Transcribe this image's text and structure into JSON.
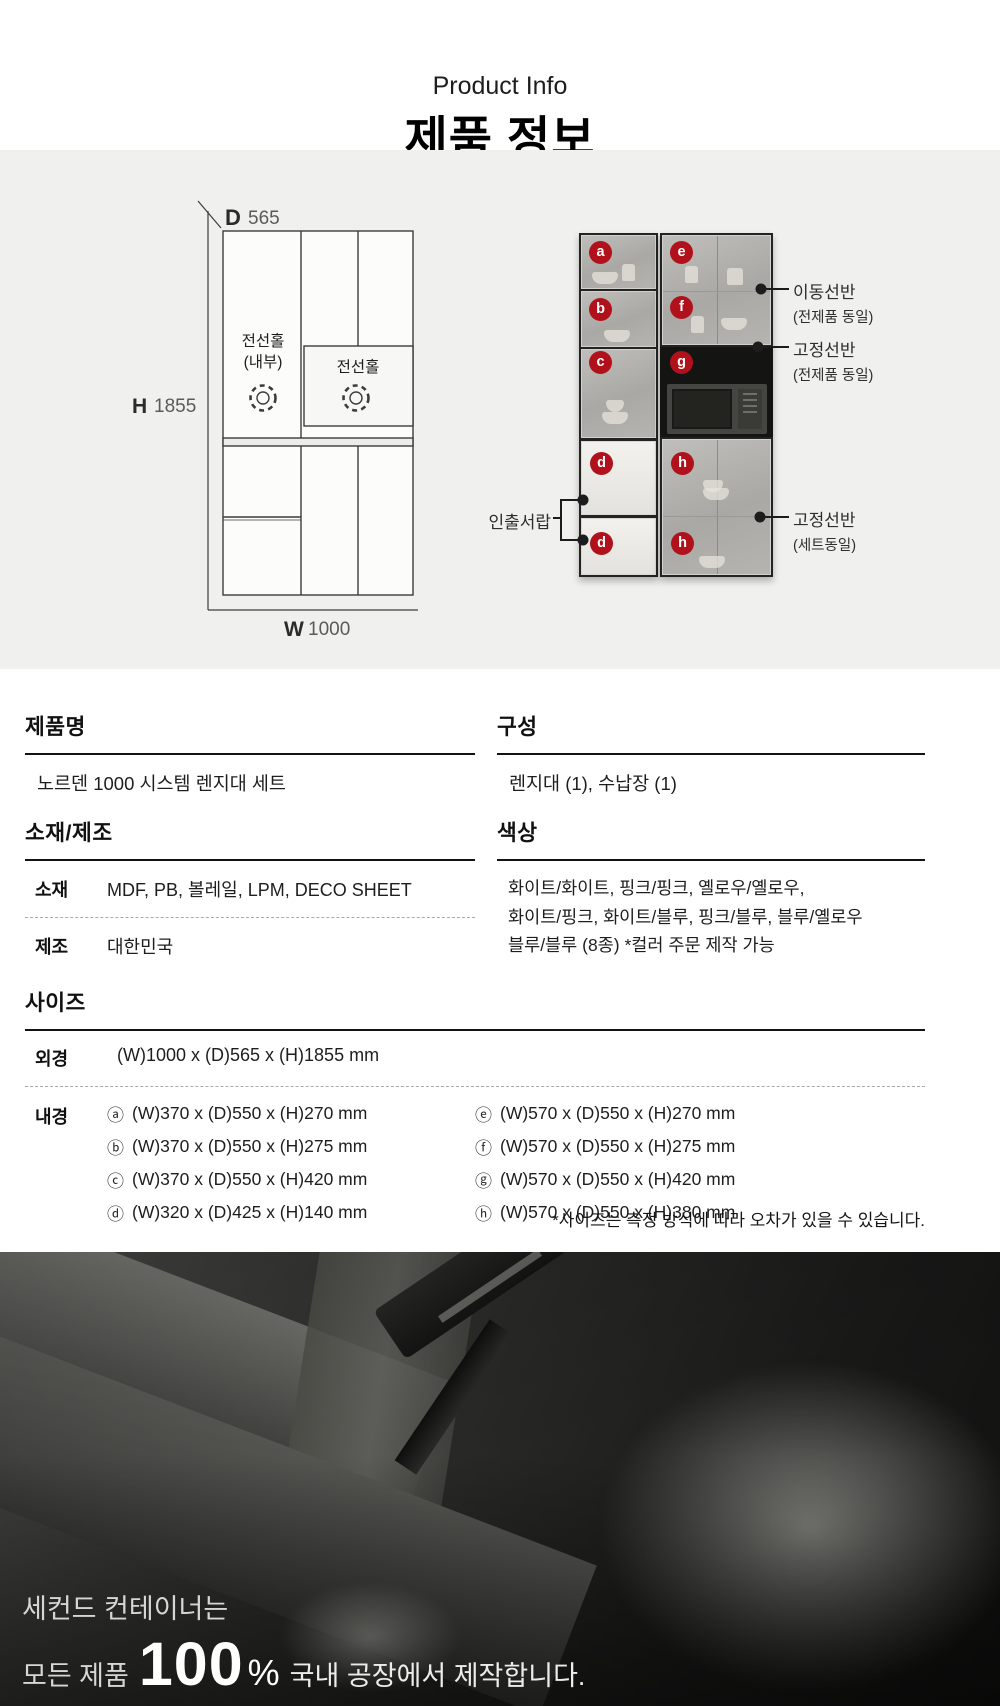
{
  "header": {
    "eyebrow": "Product Info",
    "title": "제품 정보"
  },
  "diagram": {
    "d_label": "D",
    "d_value": "565",
    "h_label": "H",
    "h_value": "1855",
    "w_label": "W",
    "w_value": "1000",
    "wire_hole_line1": "전선홀",
    "wire_hole_line2": "(내부)",
    "wire_hole_shelf": "전선홀"
  },
  "photo": {
    "left_badges": [
      "a",
      "b",
      "c",
      "d",
      "d"
    ],
    "right_badges": [
      "e",
      "f",
      "g",
      "h",
      "h"
    ],
    "callout_moving_shelf_title": "이동선반",
    "callout_moving_shelf_sub": "(전제품 동일)",
    "callout_fixed_shelf_title": "고정선반",
    "callout_fixed_shelf_sub": "(전제품 동일)",
    "callout_drawer": "인출서랍",
    "callout_fixed_shelf2_title": "고정선반",
    "callout_fixed_shelf2_sub": "(세트동일)"
  },
  "details": {
    "product_name": {
      "heading": "제품명",
      "value": "노르덴 1000 시스템 렌지대 세트"
    },
    "composition": {
      "heading": "구성",
      "value": "렌지대 (1), 수납장 (1)"
    },
    "material": {
      "heading": "소재/제조",
      "rows": [
        {
          "label": "소재",
          "value": "MDF, PB, 볼레일, LPM, DECO SHEET"
        },
        {
          "label": "제조",
          "value": "대한민국"
        }
      ]
    },
    "color": {
      "heading": "색상",
      "lines": [
        "화이트/화이트, 핑크/핑크, 옐로우/옐로우,",
        "화이트/핑크, 화이트/블루, 핑크/블루, 블루/옐로우",
        "블루/블루 (8종) *컬러 주문 제작 가능"
      ]
    },
    "size": {
      "heading": "사이즈",
      "outer_label": "외경",
      "outer_value": "(W)1000 x (D)565 x (H)1855 mm",
      "inner_label": "내경",
      "inner_left": [
        {
          "mark": "ⓐ",
          "text": "(W)370 x (D)550 x (H)270 mm"
        },
        {
          "mark": "ⓑ",
          "text": "(W)370 x (D)550 x (H)275 mm"
        },
        {
          "mark": "ⓒ",
          "text": "(W)370 x (D)550 x (H)420 mm"
        },
        {
          "mark": "ⓓ",
          "text": "(W)320 x (D)425 x (H)140 mm"
        }
      ],
      "inner_right": [
        {
          "mark": "ⓔ",
          "text": "(W)570 x (D)550 x (H)270 mm"
        },
        {
          "mark": "ⓕ",
          "text": "(W)570 x (D)550 x (H)275 mm"
        },
        {
          "mark": "ⓖ",
          "text": "(W)570 x (D)550 x (H)420 mm"
        },
        {
          "mark": "ⓗ",
          "text": "(W)570 x (D)550 x (H)380 mm"
        }
      ],
      "note": "*사이즈는 측정 방식에 따라 오차가 있을 수 있습니다."
    }
  },
  "footer": {
    "line1": "세컨드 컨테이너는",
    "line2_prefix": "모든 제품",
    "line2_number": "100",
    "line2_percent": "%",
    "line2_suffix": "국내 공장에서 제작합니다."
  },
  "colors": {
    "accent_red": "#b0111b",
    "band_bg": "#f0f0ef"
  }
}
